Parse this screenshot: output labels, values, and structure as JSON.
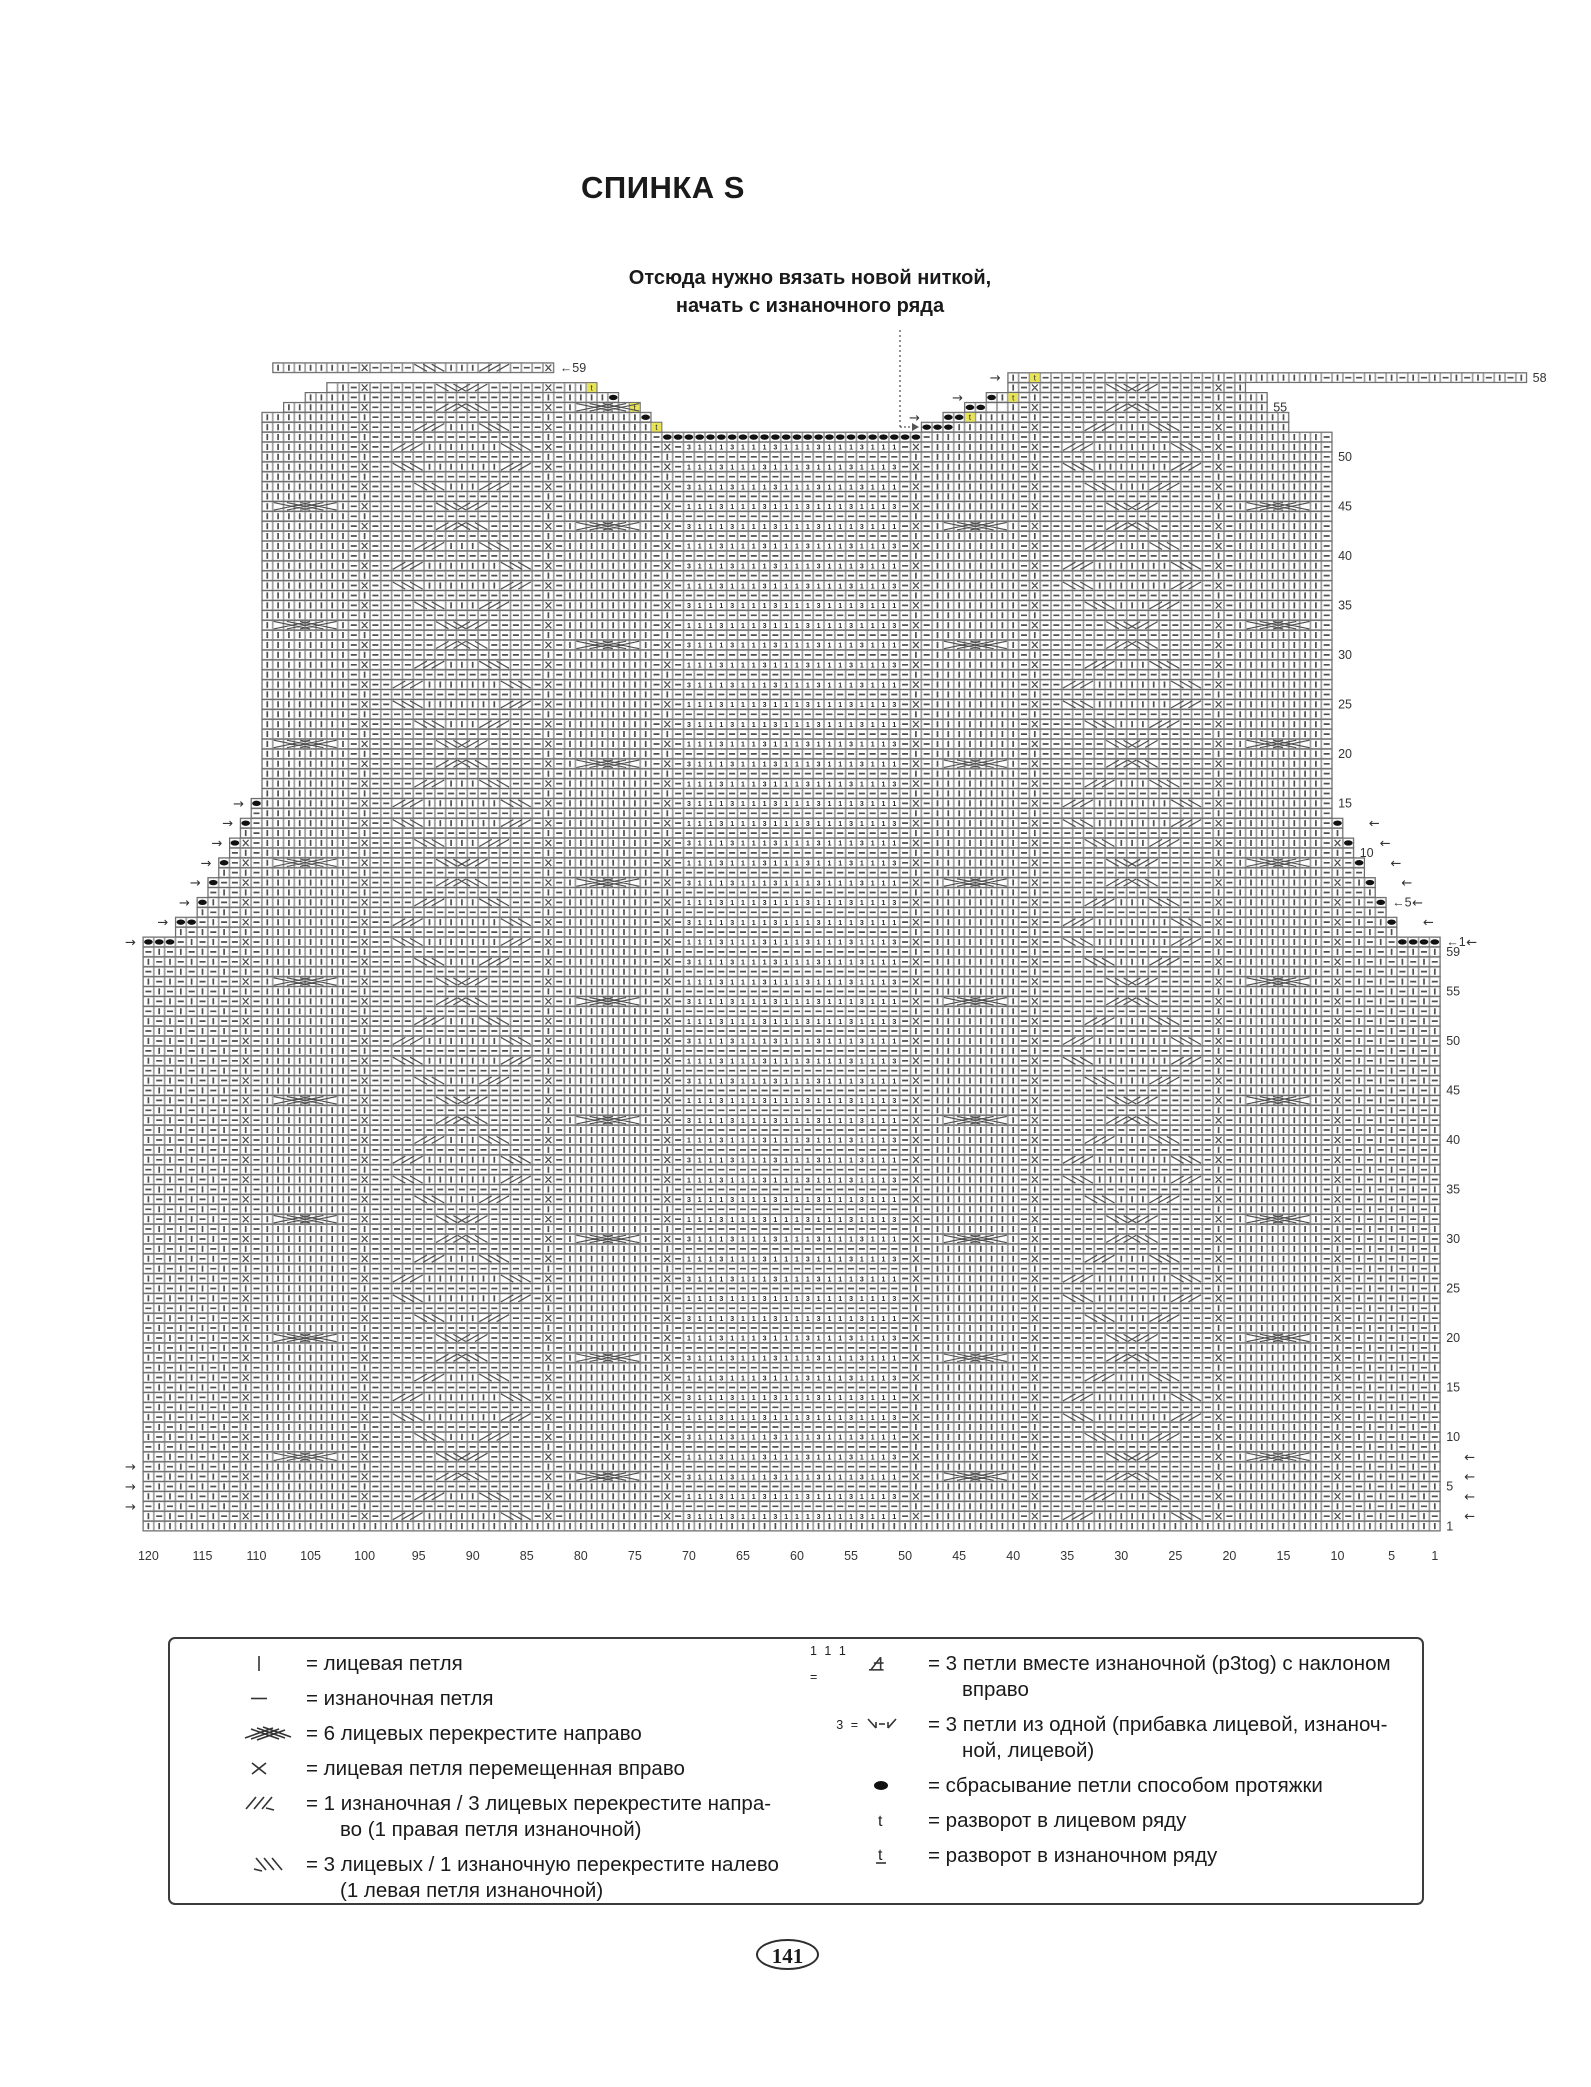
{
  "page": {
    "title": "СПИНКА S",
    "page_number": "141"
  },
  "annotation": {
    "line1": "Отсюда нужно вязать новой ниткой,",
    "line2": "начать с изнаночного ряда"
  },
  "chart": {
    "cols": 120,
    "rows": 118,
    "cell_w": 10.81,
    "cell_h": 9.9,
    "left_px": 143,
    "bottom_px": 1531,
    "colors": {
      "grid": "#9b9b9b",
      "outline": "#6a6a6a",
      "symbol": "#4f4f4f",
      "digit": "#262626",
      "oval": "#111111",
      "turn_bg": "#e8e455",
      "label": "#333333",
      "dotted": "#555555"
    },
    "bottom_labels": [
      120,
      115,
      110,
      105,
      100,
      95,
      90,
      85,
      80,
      75,
      70,
      65,
      60,
      55,
      50,
      45,
      40,
      35,
      30,
      25,
      20,
      15,
      10,
      5,
      1
    ],
    "right_labels": [
      {
        "r": 0,
        "text": "1"
      },
      {
        "r": 4,
        "text": "5"
      },
      {
        "r": 9,
        "text": "10"
      },
      {
        "r": 14,
        "text": "15"
      },
      {
        "r": 19,
        "text": "20"
      },
      {
        "r": 24,
        "text": "25"
      },
      {
        "r": 29,
        "text": "30"
      },
      {
        "r": 34,
        "text": "35"
      },
      {
        "r": 39,
        "text": "40"
      },
      {
        "r": 44,
        "text": "45"
      },
      {
        "r": 49,
        "text": "50"
      },
      {
        "r": 54,
        "text": "55"
      },
      {
        "r": 58,
        "text": "59"
      },
      {
        "r": 59,
        "text": "←1"
      },
      {
        "r": 63,
        "text": "←5"
      },
      {
        "r": 68,
        "text": "10"
      },
      {
        "r": 73,
        "text": "15"
      },
      {
        "r": 78,
        "text": "20"
      },
      {
        "r": 83,
        "text": "25"
      },
      {
        "r": 88,
        "text": "30"
      },
      {
        "r": 93,
        "text": "35"
      },
      {
        "r": 98,
        "text": "40"
      },
      {
        "r": 103,
        "text": "45"
      },
      {
        "r": 108,
        "text": "50"
      },
      {
        "r": 113,
        "text": "55"
      },
      {
        "r": 116,
        "text": "58"
      },
      {
        "r": 117,
        "text": "←59"
      }
    ],
    "shaping": {
      "armhole_bind_off_left": [
        3,
        2,
        1,
        1,
        1,
        1,
        1,
        1
      ],
      "armhole_bind_off_right": [
        4,
        1,
        1,
        1,
        1,
        1,
        1
      ],
      "neck_bind_off_center": 24,
      "neck_bind_off_right": 3
    },
    "turn_cell_letter": "t"
  },
  "legend": {
    "left": [
      {
        "symbol": "knit-stitch",
        "lines": [
          "= лицевая петля"
        ]
      },
      {
        "symbol": "purl-stitch",
        "lines": [
          "= изнаночная петля"
        ]
      },
      {
        "symbol": "cable-6-right",
        "lines": [
          "= 6 лицевых перекрестите направо"
        ]
      },
      {
        "symbol": "knit-moved-right",
        "lines": [
          "= лицевая петля перемещенная вправо"
        ]
      },
      {
        "symbol": "cross-3-1-right",
        "lines": [
          "= 1 изнаночная / 3 лицевых перекрестите напра-",
          "во (1 правая петля изнаночной)"
        ]
      },
      {
        "symbol": "cross-3-1-left",
        "lines": [
          "= 3 лицевых / 1 изнаночную перекрестите налево",
          "(1 левая петля изнаночной)"
        ]
      }
    ],
    "right": [
      {
        "prefix": "1 1 1 =",
        "symbol": "p3tog-right",
        "lines": [
          "= 3 петли вместе изнаночной (p3tog) с наклоном",
          "вправо"
        ]
      },
      {
        "prefix": "3 =",
        "symbol": "make-3",
        "lines": [
          "= 3 петли из одной (прибавка лицевой, изнаноч-",
          "ной, лицевой)"
        ]
      },
      {
        "prefix": "",
        "symbol": "drop-stitch-oval",
        "lines": [
          "= сбрасывание петли способом протяжки"
        ]
      },
      {
        "prefix": "",
        "symbol": "turn-rs",
        "lines": [
          "= разворот в лицевом ряду"
        ]
      },
      {
        "prefix": "",
        "symbol": "turn-ws",
        "lines": [
          "= разворот в изнаночном ряду"
        ]
      }
    ]
  }
}
